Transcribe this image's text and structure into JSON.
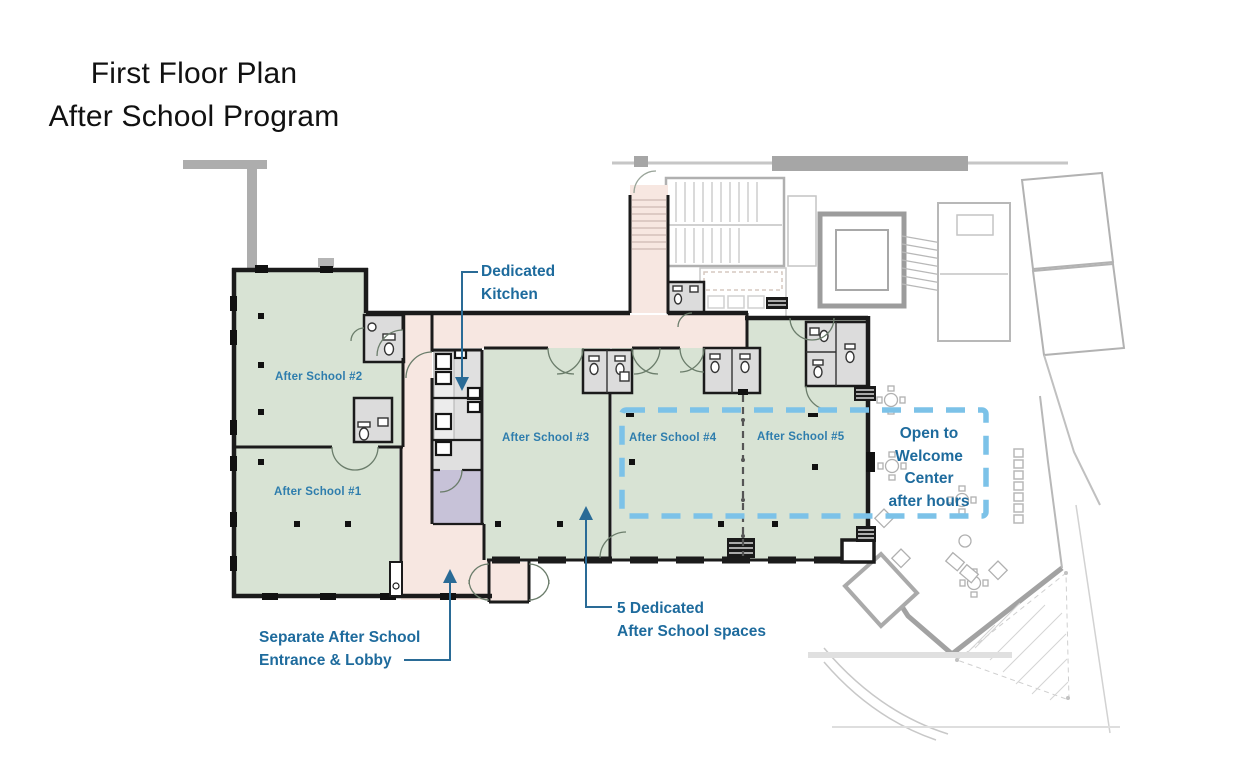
{
  "title": {
    "line1": "First Floor Plan",
    "line2": "After School Program"
  },
  "rooms": {
    "r1": "After School #1",
    "r2": "After School #2",
    "r3": "After School #3",
    "r4": "After School #4",
    "r5": "After School #5"
  },
  "annotations": {
    "kitchen": {
      "line1": "Dedicated",
      "line2": "Kitchen"
    },
    "welcome": {
      "line1": "Open to",
      "line2": "Welcome",
      "line3": "Center",
      "line4": "after hours"
    },
    "entrance": {
      "line1": "Separate After School",
      "line2": "Entrance & Lobby"
    },
    "spaces": {
      "line1": "5 Dedicated",
      "line2": "After School spaces"
    }
  },
  "colors": {
    "room_fill_green": "#d8e3d4",
    "circulation_pink": "#f7e7e1",
    "support_purple": "#c7c2d8",
    "kitchen_gray": "#e0e0e0",
    "bathroom_gray": "#dcdcdc",
    "wall_black": "#1b1b1b",
    "context_gray": "#b5b5b5",
    "highlight_dash_blue": "#7cc2e8",
    "annotation_blue": "#1e6b9d",
    "room_label_blue": "#2e7dad",
    "leader_blue": "#2a6b96"
  }
}
